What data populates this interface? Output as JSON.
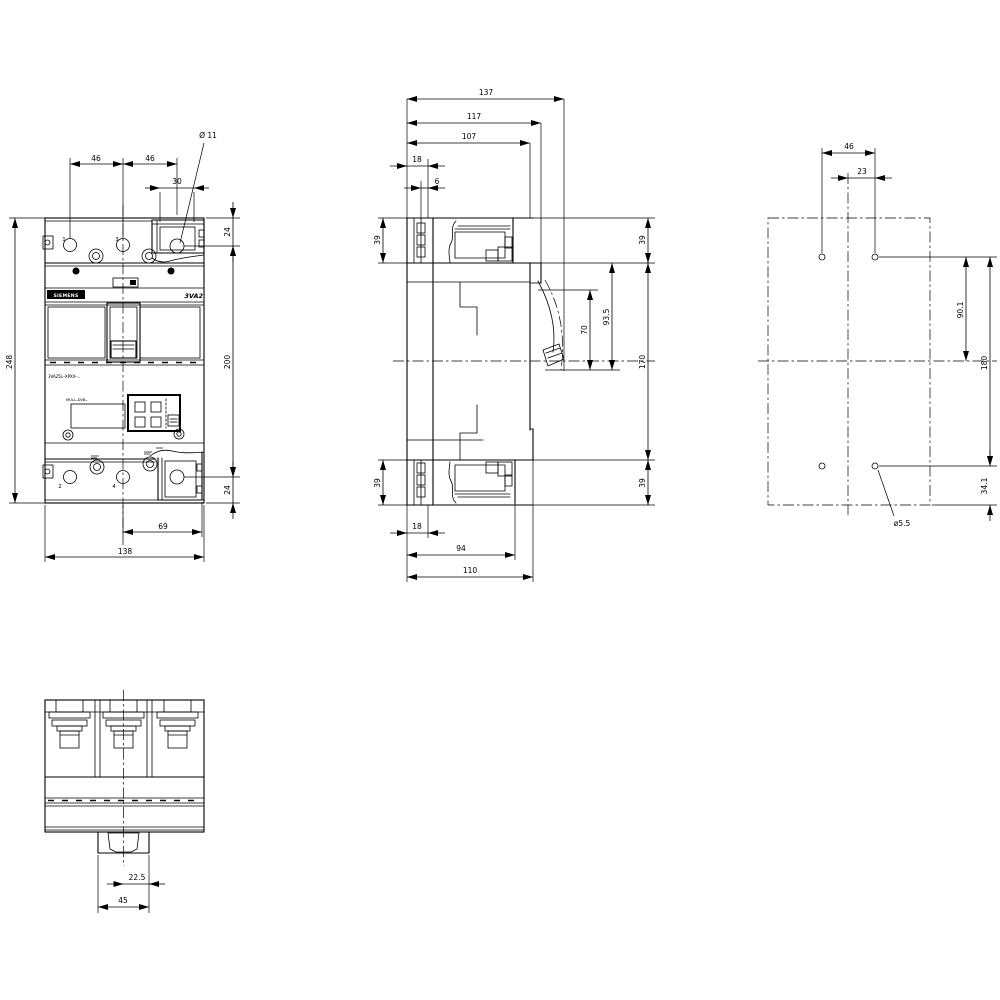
{
  "front_view": {
    "brand_plate": "SIEMENS",
    "product_family": "3VA2",
    "typecode_line": "3VA25L--XPXX--..",
    "catalog_line": "MULL.-DVB-..",
    "terminals": {
      "t1": "1",
      "t3": "3",
      "t2": "2",
      "t4": "4"
    },
    "dims": {
      "pole_pitch_left": "46",
      "pole_pitch_right": "46",
      "lug_window_width": "30",
      "lug_hole_dia": "Ø 11",
      "top_edge_to_hole": "24",
      "overall_height": "248",
      "hole_spacing_v": "200",
      "bottom_edge_to_hole": "24",
      "center_to_right_lug": "69",
      "overall_width": "138"
    }
  },
  "side_view": {
    "dims": {
      "overall_depth": "137",
      "depth_to_handle_collar": "117",
      "depth_to_front_face": "107",
      "rear_detail_18_top": "18",
      "rear_detail_6": "6",
      "terminal_zone_top_left": "39",
      "terminal_zone_top_right": "39",
      "handle_travel_max": "93.5",
      "handle_travel_min": "70",
      "cover_height": "170",
      "terminal_zone_bottom_left": "39",
      "terminal_zone_bottom_right": "39",
      "rear_detail_18_bottom": "18",
      "depth_to_terminal_front": "94",
      "depth_110": "110"
    }
  },
  "rear_view": {
    "dims": {
      "fixing_hole_pitch_h": "46",
      "center_to_fixing_hole": "23",
      "hole_to_centerline": "90.1",
      "fixing_hole_pitch_v": "180",
      "hole_to_bottom_edge": "34.1",
      "fixing_hole_dia": "ø5.5"
    }
  },
  "bottom_view": {
    "dims": {
      "center_to_rail_edge": "22.5",
      "rail_slot_width": "45"
    }
  }
}
